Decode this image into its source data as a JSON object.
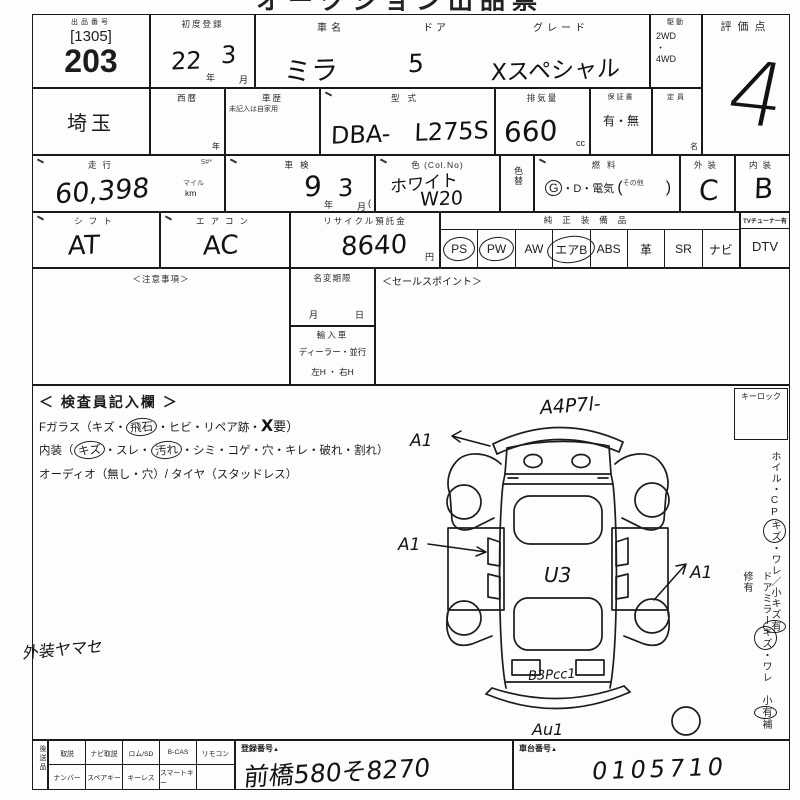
{
  "title_partial": "オークション出品票（仮）",
  "lot": {
    "header": "出品番号",
    "bracket": "[1305]",
    "number": "203",
    "prefecture": "埼玉"
  },
  "first_reg": {
    "label": "初度登録",
    "year": "22",
    "year_suffix": "年",
    "month": "3",
    "month_suffix": "月"
  },
  "seireki": {
    "label": "西暦",
    "suffix": "年"
  },
  "history": {
    "label": "車歴",
    "note": "未記入は自家用"
  },
  "car": {
    "name_label": "車名",
    "name": "ミラ",
    "door_label": "ドア",
    "door": "5",
    "grade_label": "グレード",
    "grade": "Xスペシャル"
  },
  "drive": {
    "label": "駆動",
    "opt1": "2WD",
    "dot": "・",
    "opt2": "4WD"
  },
  "score": {
    "label": "評価点",
    "value": "4"
  },
  "model": {
    "label": "型式",
    "value": "DBA-　L275S"
  },
  "displacement": {
    "label": "排気量",
    "value": "660",
    "unit": "cc"
  },
  "warranty": {
    "label": "保証書",
    "value": "有・無"
  },
  "capacity": {
    "label": "定員",
    "unit": "名"
  },
  "mileage": {
    "label": "走行",
    "flags": "S#*",
    "unit_top": "マイル",
    "unit_bottom": "km",
    "value": "60,398"
  },
  "shaken": {
    "label": "車検",
    "year": "9",
    "year_suffix": "年",
    "month": "3",
    "month_suffix": "月",
    "paren": "("
  },
  "color": {
    "label": "色 (Col.No)",
    "value1": "ホワイト",
    "value2": "W20",
    "change_label": "色替"
  },
  "fuel": {
    "label": "燃料",
    "g": "G",
    "rest": "・D・電気",
    "sonota": "その他",
    "paren_open": "(",
    "paren_close": ")"
  },
  "exterior": {
    "label": "外装",
    "value": "C"
  },
  "interior": {
    "label": "内装",
    "value": "B"
  },
  "shift": {
    "label": "シフト",
    "value": "AT"
  },
  "aircon": {
    "label": "エアコン",
    "value": "AC"
  },
  "recycle": {
    "label": "リサイクル預託金",
    "value": "8640",
    "unit": "円"
  },
  "equipment": {
    "label": "純正装備品",
    "tv_label": "TVチューナー有",
    "items": [
      {
        "t": "PS",
        "c": true
      },
      {
        "t": "PW",
        "c": true
      },
      {
        "t": "AW",
        "c": false
      },
      {
        "t": "エアB",
        "c": true
      },
      {
        "t": "ABS",
        "c": false
      },
      {
        "t": "革",
        "c": false
      },
      {
        "t": "SR",
        "c": false
      },
      {
        "t": "ナビ",
        "c": false
      }
    ],
    "dtv": "DTV"
  },
  "notes": {
    "label": "＜注意事項＞"
  },
  "namechange": {
    "label": "名変期限",
    "month": "月",
    "day": "日"
  },
  "import_car": {
    "label": "輸入車",
    "row1": "ディーラー・並行",
    "row2": "左H ・ 右H"
  },
  "sales": {
    "label": "＜セールスポイント＞"
  },
  "inspector": {
    "title": "＜ 検査員記入欄 ＞",
    "line1_pre": "Fガラス（キズ・",
    "line1_circled": "飛石",
    "line1_mid": "・ヒビ・リペア跡・",
    "line1_hw": "X",
    "line1_end": "要）",
    "line2_pre": "内装（",
    "line2_c1": "キズ",
    "line2_m1": "・スレ・",
    "line2_c2": "汚れ",
    "line2_end": "・シミ・コゲ・穴・キレ・破れ・割れ）",
    "line3": "オーディオ（無し・穴）/ タイヤ（スタッドレス）",
    "note_hw": "外装ヤマセ"
  },
  "keylock": {
    "label": "キーロック"
  },
  "side": {
    "col1_pre": "ホイル・CP",
    "col1_c1": "キズ",
    "col1_m": "・ワレ／小キズ",
    "col1_c2": "有",
    "col2_pre": "ドアミラー",
    "col2_c1": "キズ",
    "col2_m": "・ワレ 小",
    "col2_c2": "有",
    "col2_end": "補修有"
  },
  "diagram": {
    "top": "A4P7l-",
    "left_upper": "A1",
    "left_mid": "A1",
    "right": "A1",
    "center": "U3",
    "rear": "B3Pcc1",
    "bottom": "Au1"
  },
  "bottom": {
    "vertical": "後送品",
    "row1": [
      "取説",
      "ナビ取説",
      "ロム/SD",
      "B-CAS",
      "リモコン"
    ],
    "row2": [
      "ナンバー",
      "スペアキー",
      "キーレス",
      "スマートキー",
      ""
    ],
    "reg": {
      "label": "登録番号",
      "mark": "▲",
      "value": "前橋580そ8270"
    },
    "chassis": {
      "label": "車台番号",
      "mark": "▲",
      "value": "0105710"
    }
  }
}
